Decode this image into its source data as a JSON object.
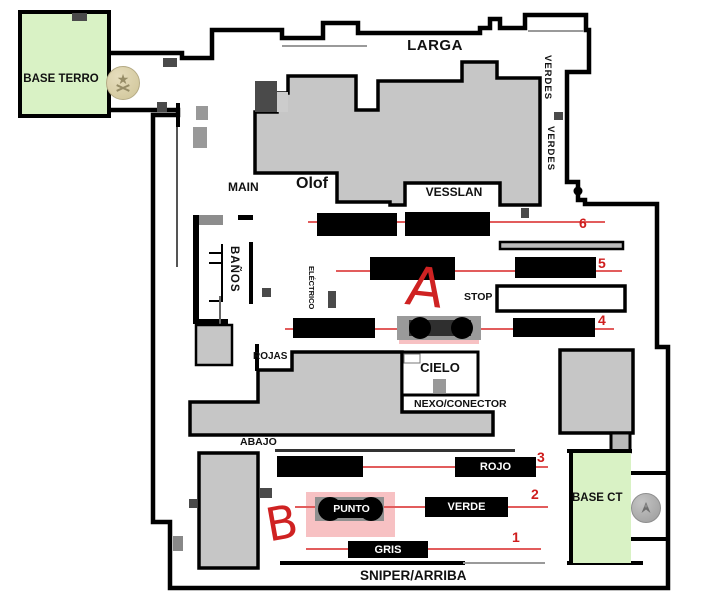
{
  "map": {
    "areas": {
      "base_terro": "BASE TERRO",
      "base_ct": "BASE CT",
      "larga": "LARGA",
      "verdes_upper": "VERDES",
      "verdes_lower": "VERDES",
      "main": "MAIN",
      "olof": "Olof",
      "vesslan": "VESSLAN",
      "banos": "BAÑOS",
      "electrico": "ELÉCTRICO",
      "stop": "STOP",
      "rojas": "ROJAS",
      "cielo": "CIELO",
      "nexo": "NEXO/CONECTOR",
      "abajo": "ABAJO",
      "sniper": "SNIPER/ARRIBA"
    },
    "crates": {
      "rojo": "ROJO",
      "verde": "VERDE",
      "gris": "GRIS",
      "punto": "PUNTO"
    },
    "sites": {
      "a": "A",
      "b": "B"
    },
    "lanes": {
      "n1": "1",
      "n2": "2",
      "n3": "3",
      "n4": "4",
      "n5": "5",
      "n6": "6"
    },
    "colors": {
      "wall": "#000000",
      "building_fill": "#c6c6c6",
      "spawn_green": "#d9f2c5",
      "lane_red": "#e25c5c",
      "number_red": "#cf1d1d",
      "mark_red": "#cf2222",
      "highlight_pink": "#f6bcbe",
      "t_badge": "#d8cfa9",
      "ct_badge": "#b3b3b3"
    },
    "badges": {
      "t": "terrorist-spawn-badge",
      "ct": "ct-spawn-badge"
    }
  }
}
